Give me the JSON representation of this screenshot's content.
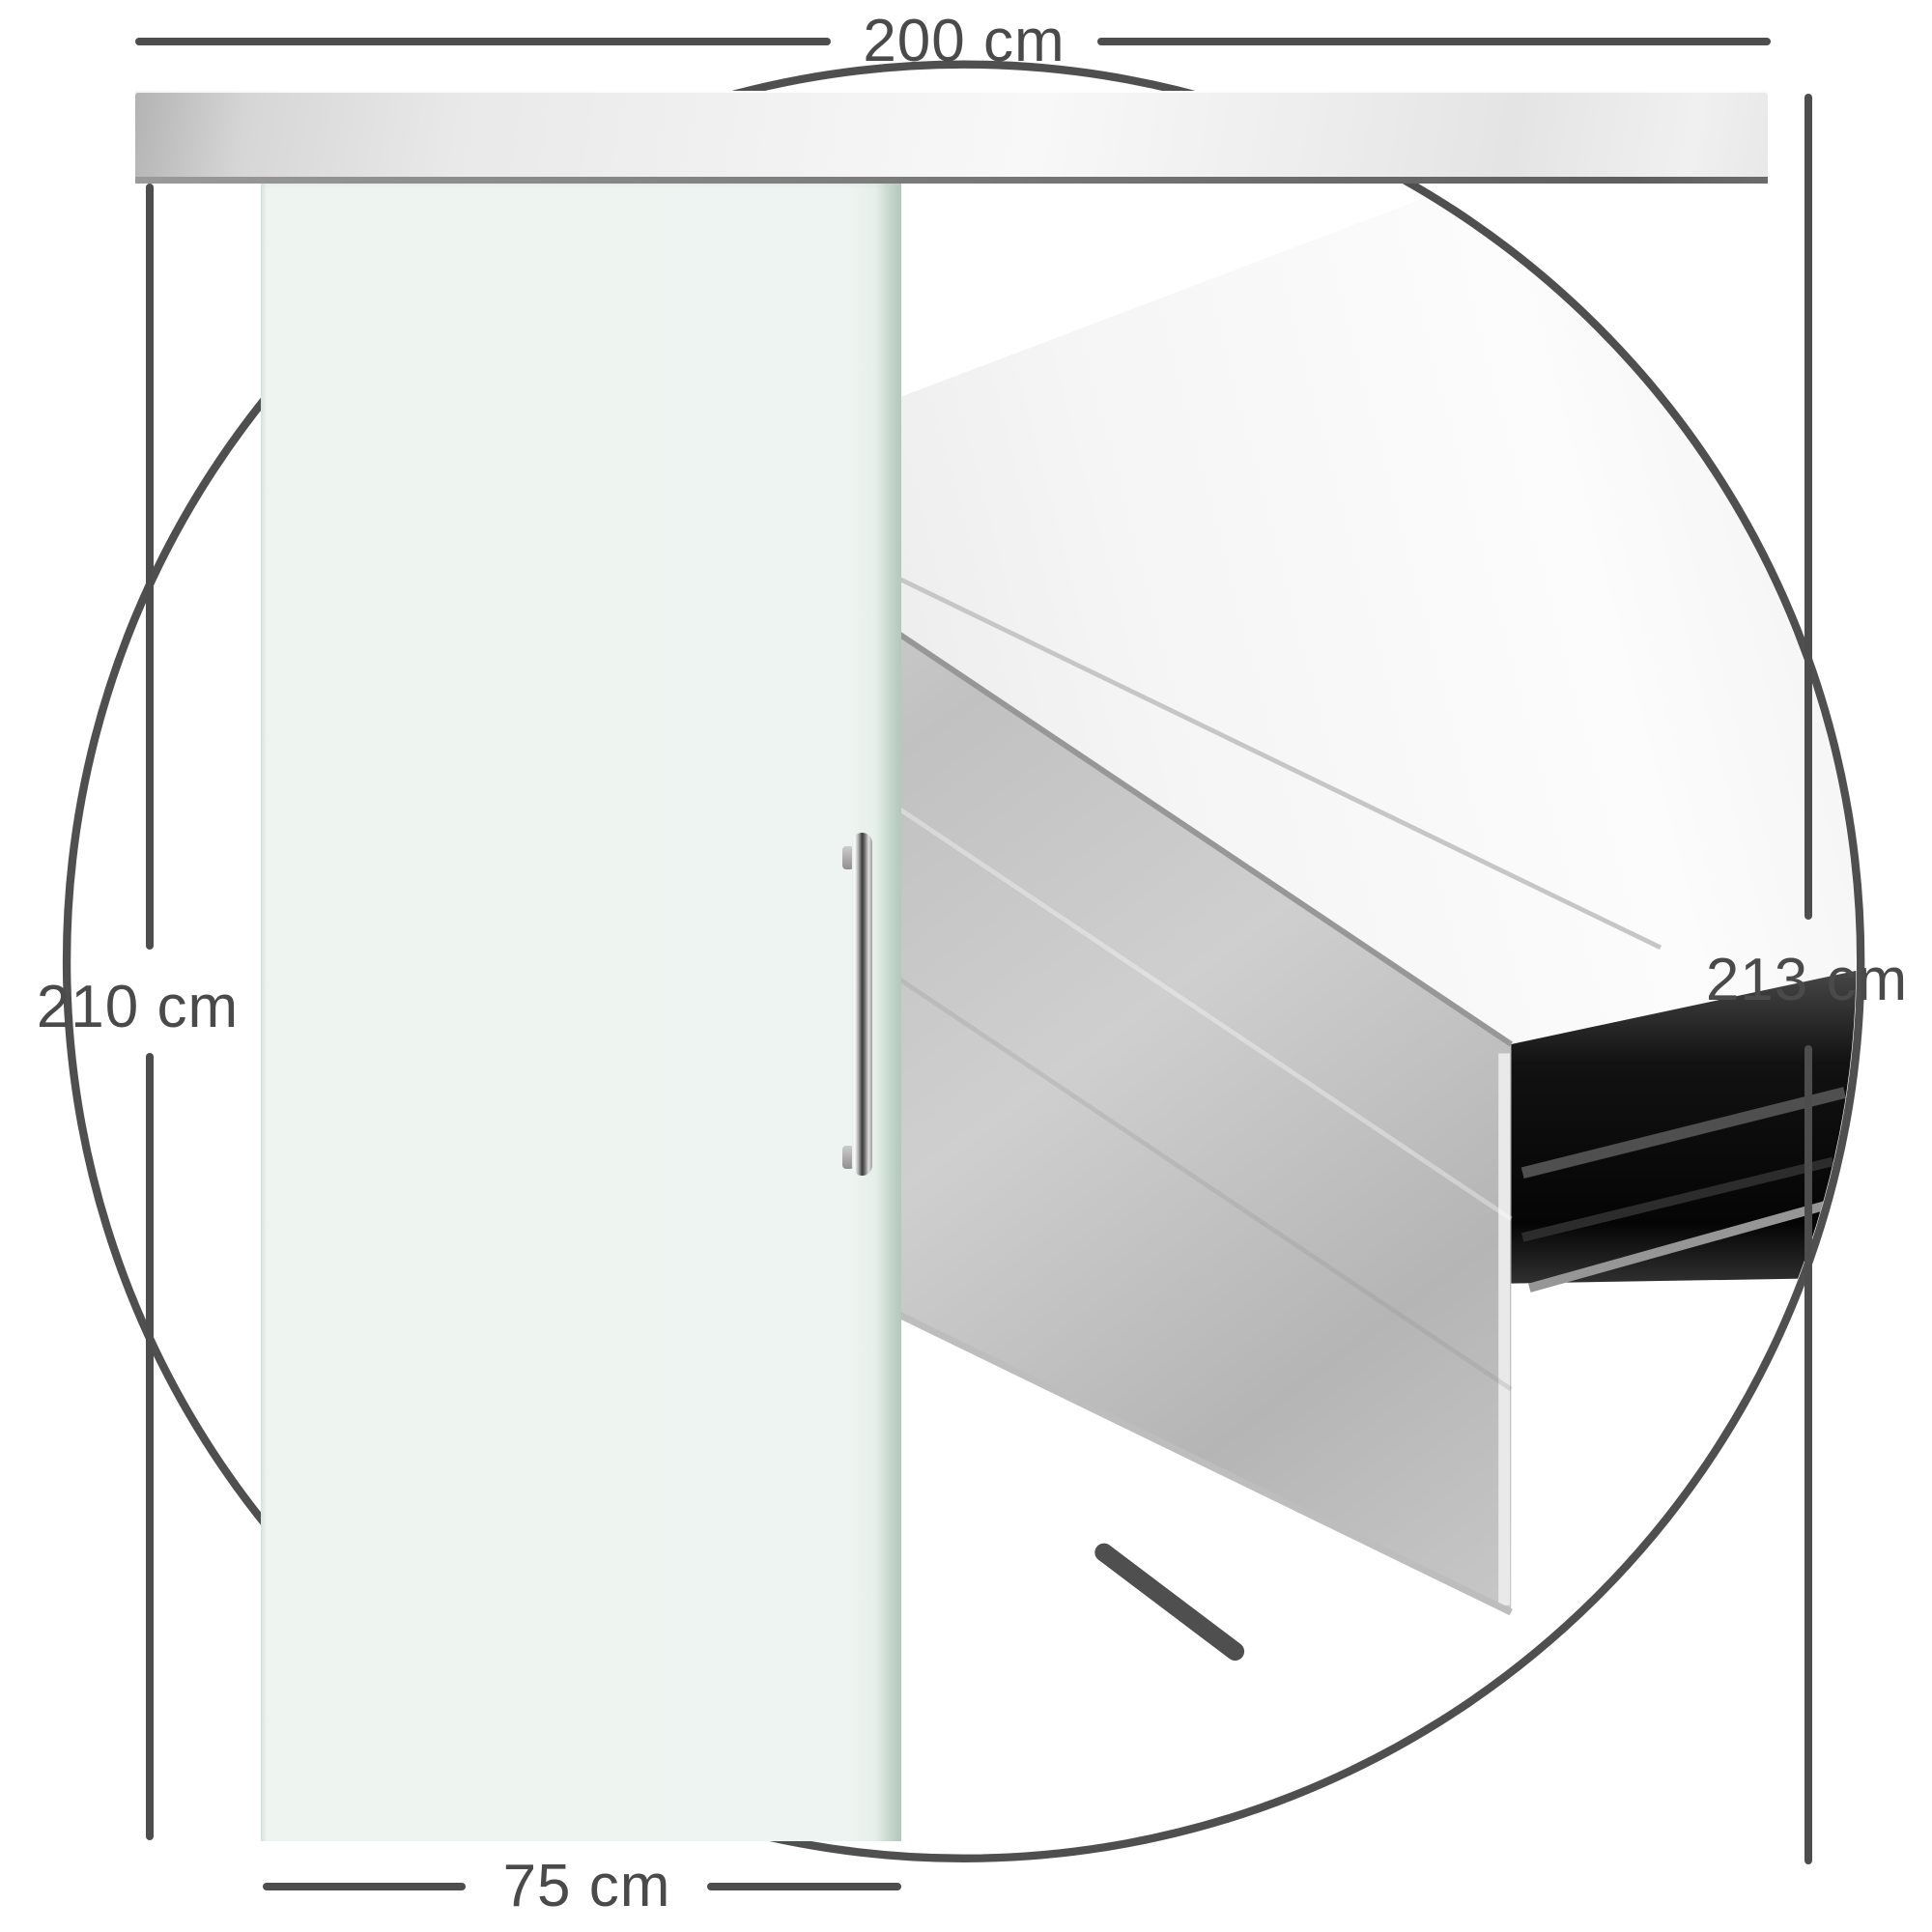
{
  "dimensions": {
    "track_width": "200 cm",
    "door_height": "210 cm",
    "total_height": "213 cm",
    "door_width": "75 cm",
    "profile_height": "4.48 cm",
    "profile_depth": "10.5 cm"
  },
  "colors": {
    "dimension_line": "#4d4d4d",
    "label_text": "#4a4a4a",
    "glass_panel": "#edf3f0",
    "glass_edge": "#b2c7bb",
    "rail_silver_light": "#f2f2f2",
    "rail_silver_dark": "#b9b9b9",
    "track_slot_dark": "#141414",
    "handle_chrome_dark": "#3a3a3a",
    "floor_guide": "#8d7c75"
  }
}
